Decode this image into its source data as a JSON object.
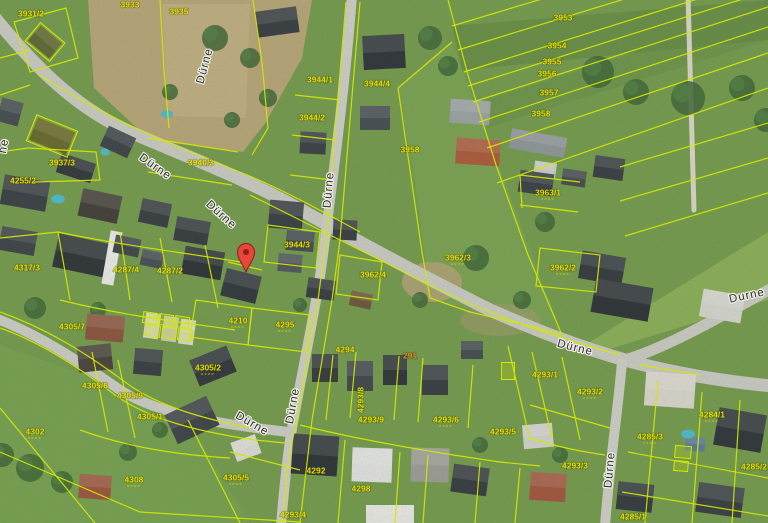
{
  "map": {
    "width": 768,
    "height": 523,
    "background": "#74994f",
    "palette": {
      "boundary": "#d3e800",
      "parcel_text": "#e3dc00",
      "parcel_text_orange": "#d4862a",
      "street_text": "#2e2e2e",
      "street_halo": "#eeeee6",
      "road": "#c7c7c1",
      "path": "#d6d3c3",
      "marker_red": "#e8453c",
      "marker_dark": "#8c1f17",
      "pool": "#4fb8c8",
      "tan_field": "#b5a378",
      "tree": "#42663a"
    },
    "fields": [
      {
        "type": "poly",
        "points": "88,0 312,0 302,58 266,122 243,152 150,140 94,88",
        "fill": "#b5a378",
        "opacity": 1
      },
      {
        "type": "poly",
        "points": "162,4 250,4 246,118 168,116",
        "fill": "#c9b88f",
        "opacity": 0.45
      },
      {
        "type": "poly",
        "points": "585,345 768,232 768,300 600,352",
        "fill": "#9dbd62",
        "opacity": 0.55
      },
      {
        "type": "poly",
        "points": "452,26 768,0 768,40 462,70",
        "fill": "#55793f",
        "opacity": 0.35
      },
      {
        "type": "poly",
        "points": "479,102 768,10 768,40 487,128",
        "fill": "#628a47",
        "opacity": 0.35
      },
      {
        "type": "poly",
        "points": "398,88 452,42 562,335 430,298 415,180",
        "fill": "#85aa5c",
        "opacity": 0.4
      },
      {
        "type": "poly",
        "points": "0,345 180,408 250,523 0,523",
        "fill": "#7ba657",
        "opacity": 0.45
      },
      {
        "type": "ellipse",
        "cx": 432,
        "cy": 282,
        "rx": 30,
        "ry": 20,
        "fill": "#b0a078",
        "opacity": 0.85
      },
      {
        "type": "ellipse",
        "cx": 500,
        "cy": 320,
        "rx": 40,
        "ry": 16,
        "fill": "#a89a74",
        "opacity": 0.5
      }
    ],
    "roads": [
      {
        "d": "M -5,18 C 30,60 70,105 130,132 C 190,158 250,180 310,215 C 370,248 430,280 490,310 C 540,332 580,347 625,360 C 680,375 730,382 772,386",
        "w": 13,
        "c": "#c7c7c1"
      },
      {
        "d": "M 625,360 C 665,348 715,320 772,288",
        "w": 11,
        "c": "#c7c7c1"
      },
      {
        "d": "M 352,-5 C 346,80 330,200 323,255 C 316,310 300,380 290,440 C 286,470 283,500 281,526",
        "w": 10,
        "c": "#cbcbc5"
      },
      {
        "d": "M 622,362 C 618,410 610,460 605,526",
        "w": 10,
        "c": "#cbcbc5"
      },
      {
        "d": "M 688,-5 L 694,210",
        "w": 5,
        "c": "#d6d3c3"
      },
      {
        "d": "M -5,318 C 40,335 80,362 120,390 C 160,415 220,424 288,432",
        "w": 10,
        "c": "#c9c9c3"
      }
    ],
    "trees": [
      [
        215,
        38,
        13
      ],
      [
        250,
        58,
        10
      ],
      [
        268,
        98,
        9
      ],
      [
        170,
        92,
        8
      ],
      [
        232,
        120,
        8
      ],
      [
        430,
        38,
        12
      ],
      [
        448,
        66,
        10
      ],
      [
        598,
        72,
        16
      ],
      [
        636,
        92,
        13
      ],
      [
        688,
        98,
        17
      ],
      [
        742,
        88,
        13
      ],
      [
        766,
        120,
        12
      ],
      [
        545,
        222,
        10
      ],
      [
        476,
        258,
        13
      ],
      [
        522,
        300,
        9
      ],
      [
        420,
        300,
        8
      ],
      [
        300,
        305,
        7
      ],
      [
        35,
        308,
        11
      ],
      [
        98,
        310,
        8
      ],
      [
        30,
        468,
        14
      ],
      [
        62,
        482,
        11
      ],
      [
        2,
        455,
        12
      ],
      [
        128,
        452,
        9
      ],
      [
        160,
        430,
        8
      ],
      [
        480,
        445,
        8
      ],
      [
        560,
        455,
        8
      ]
    ],
    "buildings": [
      [
        45,
        42,
        28,
        20,
        40,
        "#3d4248"
      ],
      [
        10,
        112,
        22,
        24,
        15,
        "#474d52"
      ],
      [
        52,
        136,
        40,
        24,
        22,
        "#4a4440"
      ],
      [
        118,
        142,
        30,
        22,
        25,
        "#3f444a"
      ],
      [
        76,
        168,
        36,
        20,
        18,
        "#35393f"
      ],
      [
        277,
        22,
        42,
        26,
        -8,
        "#3a3f45"
      ],
      [
        384,
        52,
        42,
        34,
        -3,
        "#31363c"
      ],
      [
        313,
        143,
        26,
        22,
        3,
        "#3c4147"
      ],
      [
        375,
        118,
        30,
        24,
        0,
        "#484e54"
      ],
      [
        470,
        112,
        40,
        24,
        4,
        "#9aa0a4"
      ],
      [
        478,
        152,
        44,
        26,
        4,
        "#a95a3e"
      ],
      [
        538,
        143,
        56,
        20,
        10,
        "#8e9499"
      ],
      [
        609,
        168,
        30,
        22,
        8,
        "#3a3f45"
      ],
      [
        545,
        170,
        22,
        16,
        8,
        "#c9c9c4"
      ],
      [
        25,
        193,
        46,
        30,
        10,
        "#3c4147"
      ],
      [
        100,
        206,
        40,
        28,
        12,
        "#44403b"
      ],
      [
        155,
        213,
        30,
        24,
        12,
        "#3a3f45"
      ],
      [
        18,
        241,
        36,
        24,
        10,
        "#3f444a"
      ],
      [
        84,
        256,
        58,
        34,
        12,
        "#31363b"
      ],
      [
        112,
        258,
        12,
        54,
        10,
        "#e6e6e2"
      ],
      [
        127,
        246,
        26,
        18,
        12,
        "#41474d"
      ],
      [
        152,
        259,
        22,
        16,
        12,
        "#4a5056"
      ],
      [
        192,
        231,
        34,
        24,
        10,
        "#383d43"
      ],
      [
        203,
        263,
        40,
        28,
        10,
        "#2f343a"
      ],
      [
        241,
        286,
        36,
        28,
        14,
        "#34393f"
      ],
      [
        105,
        328,
        38,
        26,
        5,
        "#8a5540"
      ],
      [
        152,
        326,
        15,
        25,
        8,
        "#d5d5d0"
      ],
      [
        170,
        329,
        15,
        25,
        8,
        "#c4c4bf"
      ],
      [
        187,
        332,
        15,
        25,
        8,
        "#d5d5d0"
      ],
      [
        286,
        215,
        34,
        28,
        5,
        "#3b4046"
      ],
      [
        300,
        241,
        28,
        20,
        5,
        "#464c52"
      ],
      [
        345,
        230,
        24,
        20,
        3,
        "#3a3f45"
      ],
      [
        290,
        263,
        24,
        18,
        5,
        "#51575d"
      ],
      [
        321,
        289,
        28,
        20,
        8,
        "#383d43"
      ],
      [
        361,
        300,
        22,
        15,
        12,
        "#6e563f"
      ],
      [
        536,
        183,
        34,
        22,
        8,
        "#3c4147"
      ],
      [
        574,
        178,
        24,
        16,
        8,
        "#474d52"
      ],
      [
        602,
        268,
        44,
        28,
        10,
        "#363b41"
      ],
      [
        622,
        300,
        58,
        34,
        10,
        "#2f343a"
      ],
      [
        722,
        306,
        42,
        28,
        10,
        "#d2d2cc"
      ],
      [
        95,
        358,
        34,
        26,
        -6,
        "#4a443e"
      ],
      [
        148,
        362,
        28,
        26,
        5,
        "#3a3f45"
      ],
      [
        213,
        366,
        40,
        28,
        -22,
        "#34393f"
      ],
      [
        192,
        420,
        46,
        32,
        -25,
        "#3f444a"
      ],
      [
        246,
        448,
        26,
        20,
        -20,
        "#d8d8d3"
      ],
      [
        95,
        487,
        32,
        24,
        4,
        "#9a5640"
      ],
      [
        325,
        368,
        26,
        28,
        0,
        "#363b41"
      ],
      [
        360,
        376,
        26,
        30,
        0,
        "#42484e"
      ],
      [
        395,
        370,
        24,
        30,
        0,
        "#31363c"
      ],
      [
        435,
        380,
        26,
        30,
        0,
        "#3a3f45"
      ],
      [
        472,
        350,
        22,
        18,
        0,
        "#474d52"
      ],
      [
        315,
        455,
        46,
        40,
        4,
        "#2f343a"
      ],
      [
        372,
        465,
        40,
        34,
        2,
        "#dedede"
      ],
      [
        430,
        465,
        38,
        34,
        2,
        "#9b9b96"
      ],
      [
        470,
        480,
        36,
        28,
        8,
        "#383d43"
      ],
      [
        390,
        514,
        48,
        18,
        0,
        "#e3e3df"
      ],
      [
        670,
        390,
        50,
        34,
        4,
        "#d6d2ca"
      ],
      [
        740,
        430,
        48,
        38,
        10,
        "#31363c"
      ],
      [
        695,
        444,
        20,
        14,
        4,
        "#5a7a96"
      ],
      [
        538,
        436,
        30,
        24,
        -5,
        "#cfcfca"
      ],
      [
        548,
        487,
        36,
        28,
        4,
        "#a05640"
      ],
      [
        635,
        497,
        36,
        28,
        6,
        "#363b41"
      ],
      [
        720,
        500,
        46,
        30,
        8,
        "#3a3f45"
      ]
    ],
    "yellow_buildings": [
      [
        150,
        318,
        14,
        11,
        8
      ],
      [
        166,
        320,
        14,
        11,
        8
      ],
      [
        182,
        322,
        14,
        11,
        8
      ],
      [
        153,
        331,
        14,
        11,
        8
      ],
      [
        169,
        333,
        14,
        11,
        8
      ],
      [
        185,
        335,
        14,
        11,
        8
      ],
      [
        508,
        371,
        13,
        17,
        0
      ],
      [
        683,
        452,
        16,
        12,
        5
      ],
      [
        681,
        466,
        14,
        10,
        5
      ],
      [
        45,
        42,
        32,
        24,
        40
      ],
      [
        52,
        136,
        44,
        28,
        22
      ]
    ],
    "pools": [
      [
        167,
        114,
        6,
        4
      ],
      [
        58,
        199,
        7,
        4.5
      ],
      [
        105,
        152,
        4.5,
        3.5
      ],
      [
        688,
        434,
        7,
        4.5
      ]
    ],
    "boundaries": [
      "M 452,26 L 768,-69",
      "M 458,50 L 768,-45",
      "M 464,72 L 768,-23",
      "M 468,86 L 768,-9",
      "M 473,102 L 768,7",
      "M 479,122 L 768,27",
      "M 487,148 L 768,53",
      "M 497,183 L 768,88",
      "M 620,167 L 768,123",
      "M 620,201 L 768,158",
      "M 625,236 L 768,193",
      "M 448,0 L 468,75 L 496,165 L 528,255 L 562,335",
      "M 398,88 L 452,42",
      "M 398,88 L 410,170 L 422,252 L 430,298",
      "M 430,298 L 470,312 L 530,326 L 562,335",
      "M 253,0 L 262,62 L 268,128 L 252,155",
      "M 160,0 L 164,70 L 169,128",
      "M 40,75 C 100,115 170,145 240,172 C 280,188 320,210 360,232",
      "M 250,195 C 310,225 380,260 450,295 C 510,322 560,338 620,355",
      "M 346,2 L 336,120 L 326,240 L 318,300 L 300,400 L 287,470 L 283,523",
      "M 360,2 L 350,120 L 340,240 L 332,300 L 312,420 L 300,523",
      "M 295,95 L 340,100",
      "M 292,135 L 336,140",
      "M 290,175 L 332,180",
      "M 268,225 L 320,232 L 316,268 L 264,262 Z",
      "M 340,255 L 382,262 L 378,300 L 336,294 Z",
      "M 520,175 L 580,182",
      "M 520,205 L 578,212",
      "M 520,175 L 522,208",
      "M 540,248 L 600,255 L 596,292 L 536,286 Z",
      "M 14,22 L 66,8 L 78,58 L 30,72 Z",
      "M 0,58 L 30,50",
      "M 0,95 L 30,85",
      "M 0,152 L 28,148 L 96,152 L 100,180 L 34,182",
      "M 148,138 L 238,152",
      "M 148,172 L 232,185",
      "M 0,238 L 58,232 C 120,245 180,252 240,262",
      "M 58,232 L 70,300",
      "M 120,232 L 130,300",
      "M 160,238 L 172,302",
      "M 205,245 L 218,308",
      "M 60,300 C 120,315 180,322 235,330",
      "M 228,262 L 262,270",
      "M 196,300 L 252,308 L 248,345 L 190,337 Z",
      "M 252,308 L 310,315 L 306,352 L 248,345 Z",
      "M 0,312 C 45,328 85,352 125,382 C 160,408 210,420 250,428",
      "M 0,328 C 40,342 80,368 115,395 C 150,420 200,432 255,440 L 285,443",
      "M 92,352 L 108,432",
      "M 118,360 L 135,438",
      "M 80,430 C 130,448 180,455 230,458",
      "M 188,420 L 240,523",
      "M 0,408 L 95,523",
      "M 0,452 L 140,512 L 300,522",
      "M 230,452 L 300,470",
      "M 333,355 L 326,420",
      "M 356,352 L 350,418",
      "M 399,356 L 394,420",
      "M 423,358 L 418,422",
      "M 473,365 L 468,428",
      "M 300,425 C 360,440 430,452 500,462 L 540,466",
      "M 345,440 L 338,523",
      "M 400,452 L 395,523",
      "M 428,455 L 423,523",
      "M 480,462 L 475,523",
      "M 520,468 L 515,523",
      "M 508,346 L 530,440",
      "M 532,352 L 552,438",
      "M 562,357 L 580,440",
      "M 530,438 C 560,448 585,452 605,455",
      "M 530,405 L 610,428",
      "M 658,380 L 645,523",
      "M 702,392 L 692,523",
      "M 740,400 L 732,523",
      "M 628,452 L 768,478",
      "M 622,492 L 768,516",
      "M 640,365 L 700,375"
    ],
    "parcel_labels": [
      {
        "t": "3931/2",
        "x": 31,
        "y": 14
      },
      {
        "t": "3933",
        "x": 130,
        "y": 5
      },
      {
        "t": "3935",
        "x": 179,
        "y": 12
      },
      {
        "t": "3937/3",
        "x": 62,
        "y": 163
      },
      {
        "t": "3940/3",
        "x": 201,
        "y": 163
      },
      {
        "t": "3944/1",
        "x": 320,
        "y": 80
      },
      {
        "t": "3944/4",
        "x": 377,
        "y": 84
      },
      {
        "t": "3944/2",
        "x": 312,
        "y": 118
      },
      {
        "t": "3944/3",
        "x": 297,
        "y": 245
      },
      {
        "t": "3953",
        "x": 563,
        "y": 18
      },
      {
        "t": "3954",
        "x": 557,
        "y": 46
      },
      {
        "t": "3955",
        "x": 552,
        "y": 62
      },
      {
        "t": "3956",
        "x": 547,
        "y": 74
      },
      {
        "t": "3957",
        "x": 549,
        "y": 93
      },
      {
        "t": "3958",
        "x": 541,
        "y": 114
      },
      {
        "t": "3958",
        "x": 410,
        "y": 150
      },
      {
        "t": "3963/1",
        "x": 548,
        "y": 193,
        "sub": true
      },
      {
        "t": "3962/3",
        "x": 458,
        "y": 258,
        "sub": true
      },
      {
        "t": "3962/4",
        "x": 373,
        "y": 275
      },
      {
        "t": "3962/2",
        "x": 563,
        "y": 268,
        "sub": true
      },
      {
        "t": "4255/2",
        "x": 23,
        "y": 181
      },
      {
        "t": "4317/3",
        "x": 27,
        "y": 268
      },
      {
        "t": "4287/4",
        "x": 126,
        "y": 270
      },
      {
        "t": "4287/2",
        "x": 170,
        "y": 271
      },
      {
        "t": "4210",
        "x": 238,
        "y": 321,
        "sub": true
      },
      {
        "t": "4295",
        "x": 285,
        "y": 325,
        "sub": true
      },
      {
        "t": "4305/7",
        "x": 72,
        "y": 327
      },
      {
        "t": "4305/2",
        "x": 208,
        "y": 368,
        "sub": true
      },
      {
        "t": "4305/6",
        "x": 95,
        "y": 386
      },
      {
        "t": "4305/9",
        "x": 130,
        "y": 396
      },
      {
        "t": "4305/1",
        "x": 150,
        "y": 417
      },
      {
        "t": "4302",
        "x": 35,
        "y": 432,
        "sub": true
      },
      {
        "t": "4308",
        "x": 134,
        "y": 480,
        "sub": true
      },
      {
        "t": "4305/5",
        "x": 236,
        "y": 478,
        "sub": true
      },
      {
        "t": "4294",
        "x": 345,
        "y": 350
      },
      {
        "t": "291",
        "x": 410,
        "y": 356,
        "c": "orange"
      },
      {
        "t": "4293/8",
        "x": 361,
        "y": 400,
        "r": -90
      },
      {
        "t": "4293/9",
        "x": 371,
        "y": 420
      },
      {
        "t": "4293/6",
        "x": 446,
        "y": 420,
        "sub": true
      },
      {
        "t": "4293/5",
        "x": 503,
        "y": 432
      },
      {
        "t": "4292",
        "x": 316,
        "y": 471
      },
      {
        "t": "4298",
        "x": 361,
        "y": 489
      },
      {
        "t": "4293/4",
        "x": 293,
        "y": 515
      },
      {
        "t": "4293/1",
        "x": 545,
        "y": 375
      },
      {
        "t": "4293/2",
        "x": 590,
        "y": 392,
        "sub": true
      },
      {
        "t": "4293/3",
        "x": 575,
        "y": 466
      },
      {
        "t": "4284/1",
        "x": 712,
        "y": 415,
        "sub": true
      },
      {
        "t": "4285/3",
        "x": 650,
        "y": 437,
        "sub": true
      },
      {
        "t": "4285/2",
        "x": 754,
        "y": 467
      },
      {
        "t": "4285/1",
        "x": 633,
        "y": 517
      }
    ],
    "street_labels": [
      {
        "t": "Dürne",
        "x": 205,
        "y": 66,
        "r": -75
      },
      {
        "t": "Dürne",
        "x": 155,
        "y": 167,
        "r": 35
      },
      {
        "t": "Dürne",
        "x": 221,
        "y": 215,
        "r": 42
      },
      {
        "t": "Dürne",
        "x": 329,
        "y": 190,
        "r": -85
      },
      {
        "t": "Dürne",
        "x": 293,
        "y": 406,
        "r": -80
      },
      {
        "t": "Dürne",
        "x": 575,
        "y": 348,
        "r": 14
      },
      {
        "t": "Durne",
        "x": 747,
        "y": 296,
        "r": -12
      },
      {
        "t": "Dürne",
        "x": 252,
        "y": 424,
        "r": 30
      },
      {
        "t": "Dürne",
        "x": 610,
        "y": 470,
        "r": -85
      },
      {
        "t": "ne",
        "x": 4,
        "y": 146,
        "r": -80
      }
    ],
    "marker": {
      "x": 246,
      "y": 272
    }
  }
}
